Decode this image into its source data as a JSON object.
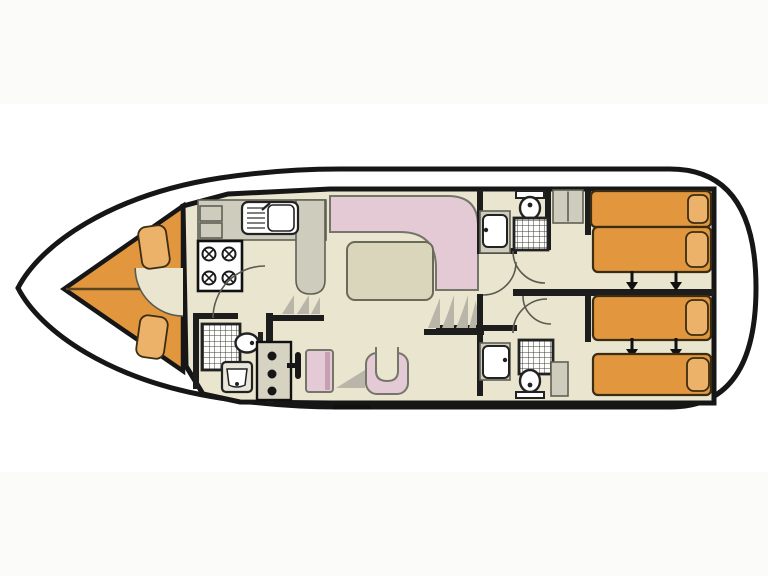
{
  "page": {
    "background": "#ffffff",
    "canvas_w": 768,
    "canvas_h": 576
  },
  "diagram": {
    "type": "houseboat-floor-plan",
    "view": "top-down-deck-plan",
    "orientation": {
      "bow": "left",
      "stern": "right"
    },
    "colors": {
      "hull-outline": "#161616",
      "wall": "#1d1d1d",
      "deck": "#ffffff",
      "floor": "#e9e5cf",
      "counter": "#cdccbd",
      "upholstery-pink": "#e3cad5",
      "upholstery-pink-dark": "#c79fb4",
      "bed-orange": "#e2973e",
      "pillow-orange": "#ecb26a",
      "table-top": "#d9d6bb",
      "shading": "#b9b5a8",
      "fixture": "#ffffff",
      "fixture-outline": "#222222",
      "arc": "#5a5a50",
      "page-band": "#fbfbfa"
    },
    "areas": [
      {
        "name": "bow-seating",
        "shape": "pointed-bow",
        "cushions": 2
      },
      {
        "name": "galley",
        "fixtures": [
          "sink-with-drainer",
          "four-burner-stove",
          "counter-peninsula",
          "storage-lockers"
        ]
      },
      {
        "name": "salon",
        "fixtures": [
          "l-shaped-sofa",
          "dining-table"
        ]
      },
      {
        "name": "helm-station",
        "fixtures": [
          "console-with-three-knobs",
          "steering-wheel",
          "pilot-seat",
          "u-shaped-seat"
        ]
      },
      {
        "name": "forward-bathroom",
        "fixtures": [
          "shower",
          "toilet",
          "washbasin"
        ]
      },
      {
        "name": "aft-bathroom-top",
        "fixtures": [
          "washbasin",
          "toilet",
          "shower"
        ]
      },
      {
        "name": "aft-bathroom-bottom",
        "fixtures": [
          "washbasin",
          "shower",
          "toilet",
          "cabinet"
        ]
      },
      {
        "name": "aft-cabin-top",
        "beds": 2,
        "slide_arrows": 2,
        "fixtures": [
          "wardrobe"
        ]
      },
      {
        "name": "aft-cabin-bottom",
        "beds": 2,
        "slide_arrows": 2,
        "fixtures": [
          "cabinet"
        ]
      },
      {
        "name": "side-steps",
        "steps": 3
      },
      {
        "name": "aft-steps",
        "steps": 4
      },
      {
        "name": "boarding-step",
        "position": "bottom-center"
      }
    ],
    "counts": {
      "beds": 4,
      "bed-pillows": 4,
      "slide-arrows": 4,
      "showers": 3,
      "toilets": 3,
      "washbasins": 3,
      "stove-burners": 4,
      "door-swings": 6,
      "bow-cushions": 2
    }
  }
}
